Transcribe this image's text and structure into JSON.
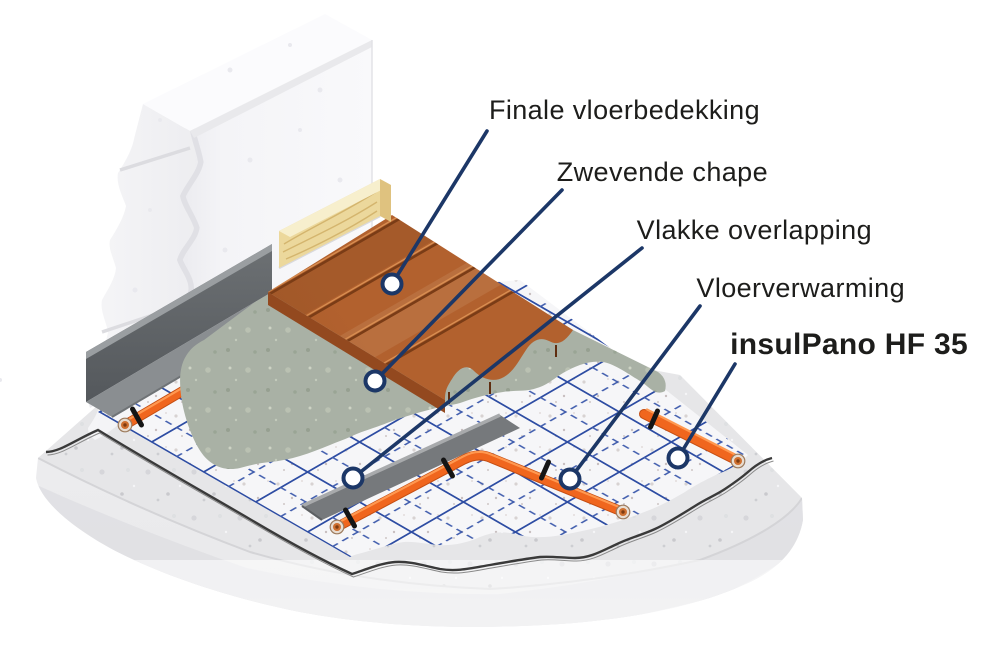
{
  "diagram": {
    "kind": "isometric-floor-construction-cutaway",
    "language": "nl"
  },
  "callouts": [
    {
      "id": "finale",
      "text": "Finale vloerbedekking"
    },
    {
      "id": "chape",
      "text": "Zwevende chape"
    },
    {
      "id": "overlap",
      "text": "Vlakke overlapping"
    },
    {
      "id": "verwarming",
      "text": "Vloerverwarming"
    },
    {
      "id": "product",
      "text": "insulPano HF 35",
      "emphasis": "brand-red"
    }
  ],
  "colors": {
    "background": "#ffffff",
    "label_text": "#1d1d1b",
    "product_red": "#e6382d",
    "leader_line": "#1c3767",
    "marker_fill": "#ffffff",
    "grid_blue": "#2e4da3",
    "grid_blue_dashed": "#3d5aac",
    "pipe_orange": "#f0661e",
    "pipe_shadow": "#c44d12",
    "pipe_highlight": "#ff9850",
    "pipe_clip_black": "#151515",
    "insulation_top": "#f6f6f8",
    "insulation_side": "#f1efef",
    "foil_line": "#3a3a3a",
    "screed_top": "#a9b1a5",
    "screed_side": "#8d978a",
    "wood_top": "#b2612e",
    "wood_side": "#7e3d18",
    "wood_seam": "#7a3c16",
    "slab_top": "#e6e6e8",
    "slab_face": "#ececee",
    "edge_strip": "#5f6367",
    "edge_strip_flange": "#8a8e91",
    "skirting": "#ecd89c",
    "wall": "#f7f7f9"
  }
}
